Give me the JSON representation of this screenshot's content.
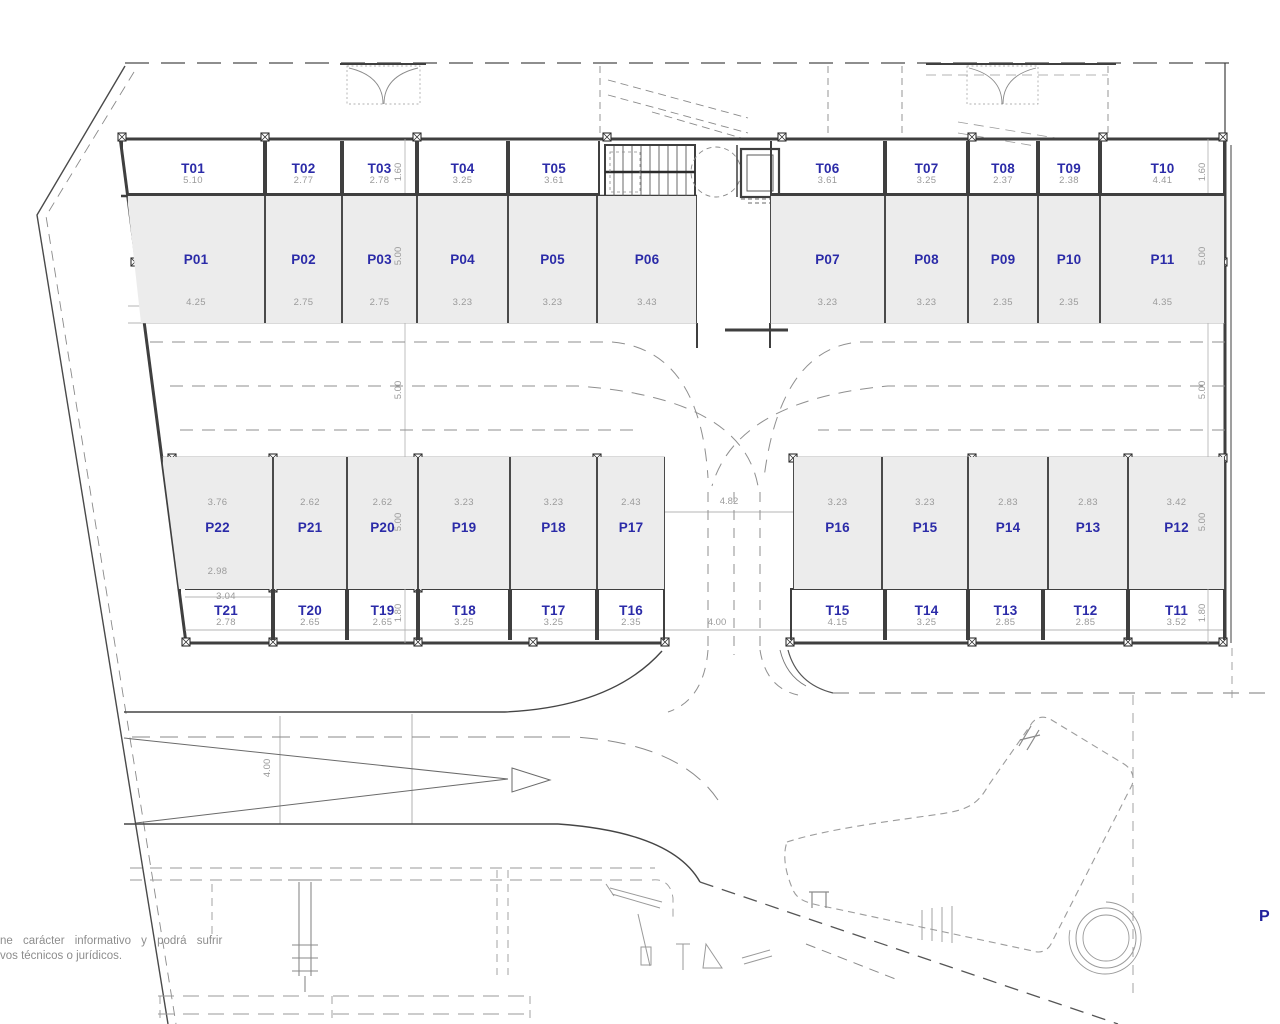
{
  "plan": {
    "disclaimer_line1": "ne carácter informativo y podrá sufrir",
    "disclaimer_line2": "vos técnicos o jurídicos.",
    "corner_label": "P"
  },
  "colors": {
    "unit_label": "#2b2ba8",
    "dimension_text": "#9b9b9b",
    "parking_fill": "#ececec",
    "wall_line": "#3f3f3f"
  },
  "units": {
    "storage_top": [
      {
        "id": "T01",
        "dim": "5.10"
      },
      {
        "id": "T02",
        "dim": "2.77"
      },
      {
        "id": "T03",
        "dim": "2.78"
      },
      {
        "id": "T04",
        "dim": "3.25"
      },
      {
        "id": "T05",
        "dim": "3.61"
      }
    ],
    "storage_top_right": [
      {
        "id": "T06",
        "dim": "3.61"
      },
      {
        "id": "T07",
        "dim": "3.25"
      },
      {
        "id": "T08",
        "dim": "2.37"
      },
      {
        "id": "T09",
        "dim": "2.38"
      },
      {
        "id": "T10",
        "dim": "4.41"
      }
    ],
    "parking_top": [
      {
        "id": "P01",
        "dim": "4.25"
      },
      {
        "id": "P02",
        "dim": "2.75"
      },
      {
        "id": "P03",
        "dim": "2.75"
      },
      {
        "id": "P04",
        "dim": "3.23"
      },
      {
        "id": "P05",
        "dim": "3.23"
      },
      {
        "id": "P06",
        "dim": "3.43"
      }
    ],
    "parking_top_right": [
      {
        "id": "P07",
        "dim": "3.23"
      },
      {
        "id": "P08",
        "dim": "3.23"
      },
      {
        "id": "P09",
        "dim": "2.35"
      },
      {
        "id": "P10",
        "dim": "2.35"
      },
      {
        "id": "P11",
        "dim": "4.35"
      }
    ],
    "parking_bottom": [
      {
        "id": "P22",
        "dim": "3.76",
        "dim2": "2.98"
      },
      {
        "id": "P21",
        "dim": "2.62"
      },
      {
        "id": "P20",
        "dim": "2.62"
      },
      {
        "id": "P19",
        "dim": "3.23"
      },
      {
        "id": "P18",
        "dim": "3.23"
      },
      {
        "id": "P17",
        "dim": "2.43"
      }
    ],
    "parking_bottom_right": [
      {
        "id": "P16",
        "dim": "3.23"
      },
      {
        "id": "P15",
        "dim": "3.23"
      },
      {
        "id": "P14",
        "dim": "2.83"
      },
      {
        "id": "P13",
        "dim": "2.83"
      },
      {
        "id": "P12",
        "dim": "3.42"
      }
    ],
    "storage_bottom": [
      {
        "id": "T21",
        "dim": "2.78",
        "dim2": "3.04"
      },
      {
        "id": "T20",
        "dim": "2.65"
      },
      {
        "id": "T19",
        "dim": "2.65"
      },
      {
        "id": "T18",
        "dim": "3.25"
      },
      {
        "id": "T17",
        "dim": "3.25"
      },
      {
        "id": "T16",
        "dim": "2.35"
      }
    ],
    "storage_bottom_right": [
      {
        "id": "T15",
        "dim": "4.15"
      },
      {
        "id": "T14",
        "dim": "3.25"
      },
      {
        "id": "T13",
        "dim": "2.85"
      },
      {
        "id": "T12",
        "dim": "2.85"
      },
      {
        "id": "T11",
        "dim": "3.52"
      }
    ]
  },
  "dims": {
    "v_left": [
      "1.60",
      "5.00",
      "5.00",
      "5.00",
      "1.80"
    ],
    "v_right": [
      "1.60",
      "5.00",
      "5.00",
      "5.00",
      "1.80"
    ],
    "ramp": "4.00",
    "lane_top": "4.82",
    "lane_bottom": "4.00"
  }
}
